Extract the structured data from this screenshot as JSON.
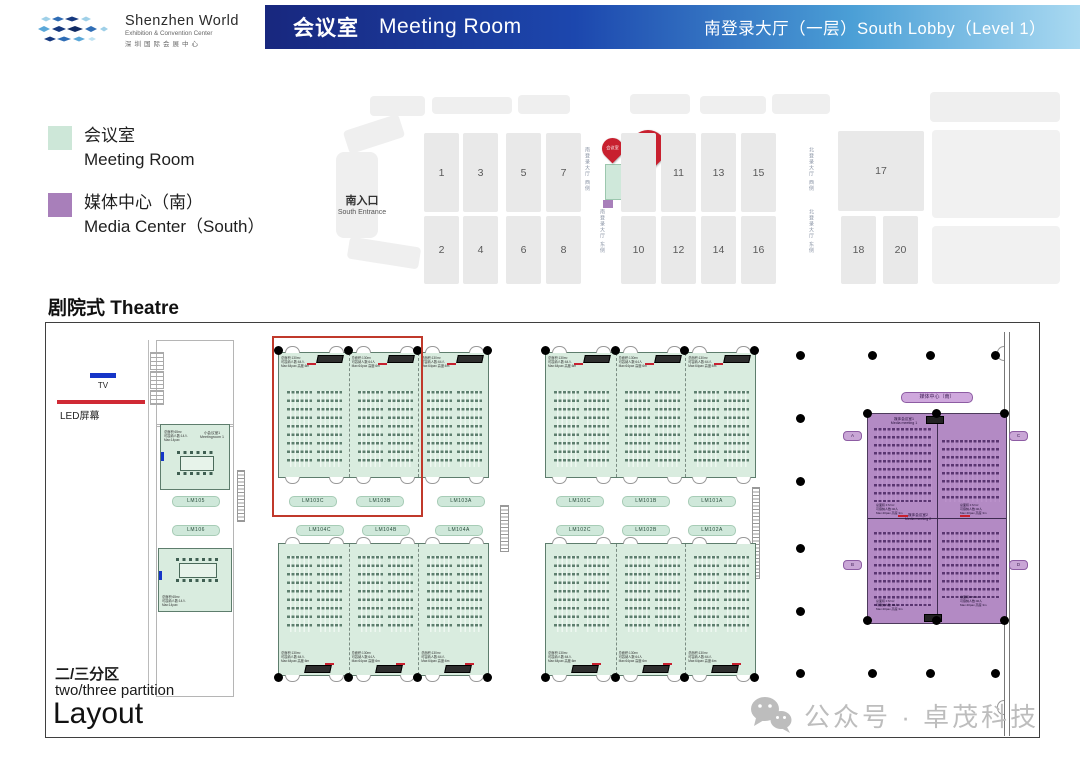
{
  "header": {
    "logo_name": "Shenzhen World",
    "logo_sub": "Exhibition & Convention Center",
    "logo_cn": "深圳国际会展中心",
    "title_cn": "会议室",
    "title_en": "Meeting Room",
    "location": "南登录大厅（一层）South Lobby（Level 1）"
  },
  "legend": {
    "meeting_cn": "会议室",
    "meeting_en": "Meeting Room",
    "meeting_color": "#cde7d8",
    "media_cn": "媒体中心（南）",
    "media_en": "Media Center（South）",
    "media_color": "#a87fba"
  },
  "minimap": {
    "entrance_cn": "南入口",
    "entrance_en": "South Entrance",
    "hall_numbers": [
      "1",
      "3",
      "5",
      "7",
      "",
      "11",
      "13",
      "15",
      "17",
      "2",
      "4",
      "6",
      "8",
      "10",
      "12",
      "14",
      "16",
      "18",
      "20"
    ],
    "corridor_labels": [
      "南登录大厅 西侧",
      "南登录大厅 东侧",
      "北登录大厅 西侧",
      "北登录大厅 东侧"
    ],
    "pin_small_label": "会议室",
    "pin_big_number": "9",
    "pin_big_label": "号馆",
    "pin_color": "#c8202f"
  },
  "plan": {
    "title": "剧院式 Theatre",
    "tv_label": "TV",
    "led_label": "LED屏幕",
    "partition_cn": "二/三分区",
    "partition_en": "two/three partition",
    "layout_label": "Layout",
    "room_labels_top": [
      "LM105",
      "LM103C",
      "LM103B",
      "LM103A",
      "LM101C",
      "LM101B",
      "LM101A"
    ],
    "room_labels_bottom": [
      "LM106",
      "LM104C",
      "LM104B",
      "LM104A",
      "LM102C",
      "LM102B",
      "LM102A"
    ],
    "room_info_lines": "总面积:130m²\n可容纳人数:64人\nMax:64pax 高度:6m",
    "small_room_name": "小会议室1\nMeetingroom 1",
    "small_room_info": "总面积:65m²\n可容纳人数:14人\nMax:14pax",
    "media": {
      "pill": "媒体中心（南）",
      "room1_cn": "媒体会议室1",
      "room1_en": "Media meeting 1",
      "room2_cn": "媒体会议室2",
      "room2_en": "Media meeting 2",
      "info": "总面积:172m²\n可容纳人数:40人\nMax:40pax 高度:3m",
      "side_labels": [
        "A",
        "C",
        "B",
        "D"
      ]
    }
  },
  "watermark": {
    "text": "公众号 · 卓茂科技"
  }
}
